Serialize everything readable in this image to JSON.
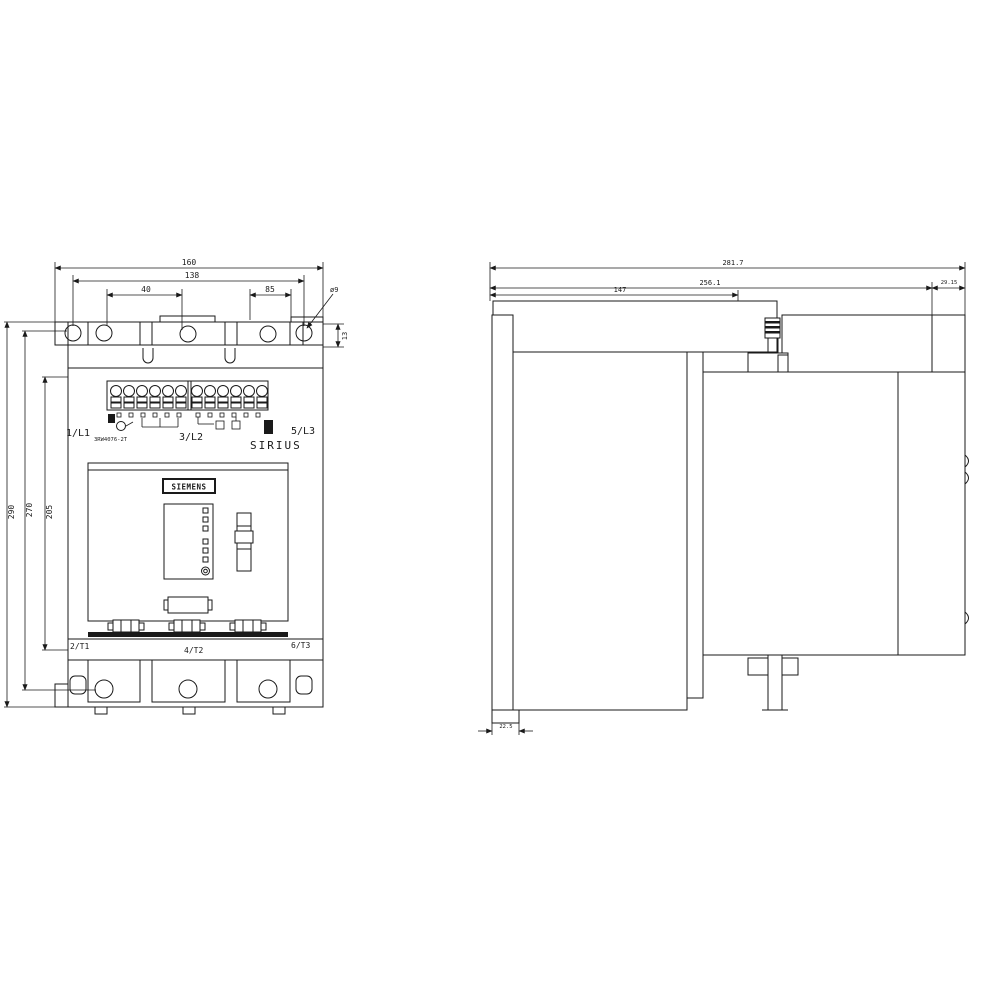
{
  "front_view": {
    "brand_label": "SIEMENS",
    "series_label": "SIRIUS",
    "type_label": "3RW4076-2T",
    "terminals": {
      "l1": "1/L1",
      "l2": "3/L2",
      "l3": "5/L3",
      "t1": "2/T1",
      "t2": "4/T2",
      "t3": "6/T3"
    },
    "dims": {
      "overall_width": "160",
      "mounting_width": "138",
      "hole_offset_left": "40",
      "hole_offset_right": "85",
      "hole_diameter": "ø9",
      "lug_slot_height": "13",
      "overall_height": "290",
      "mounting_height": "270",
      "body_height": "205"
    }
  },
  "side_view": {
    "dims": {
      "overall_depth": "281.7",
      "mounting_depth": "256.1",
      "base_depth": "147",
      "cover_depth": "29.15",
      "foot_depth": "22.5"
    }
  }
}
